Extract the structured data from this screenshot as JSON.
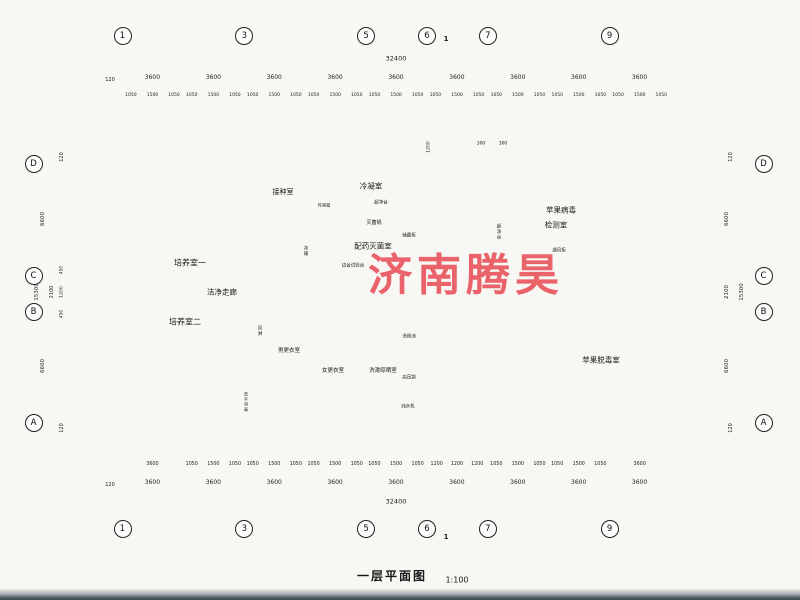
{
  "watermark": {
    "text": "济南腾昊",
    "color": "#e8434e"
  },
  "title": {
    "name": "一层平面图",
    "scale": "1:100"
  },
  "section_mark": {
    "top": "1",
    "bottom": "1"
  },
  "grid_bubbles": {
    "top": [
      "1",
      "3",
      "5",
      "6",
      "7",
      "9"
    ],
    "bottom": [
      "1",
      "3",
      "5",
      "6",
      "7",
      "9"
    ],
    "left": [
      "D",
      "C",
      "B",
      "A"
    ],
    "right": [
      "D",
      "C",
      "B",
      "A"
    ]
  },
  "dims": {
    "top": {
      "overall": "32400",
      "edge": "120",
      "bays": [
        "3600",
        "3600",
        "3600",
        "3600",
        "3600",
        "3600",
        "3600",
        "3600",
        "3600"
      ],
      "sub": [
        "1050",
        "1500",
        "1050",
        "1050",
        "1500",
        "1050",
        "1050",
        "1500",
        "1050",
        "1050",
        "1500",
        "1050",
        "1050",
        "1500",
        "1050",
        "1050",
        "1500",
        "1050",
        "1050",
        "1500",
        "1050",
        "1050",
        "1500",
        "1050",
        "1050",
        "1500",
        "1050"
      ]
    },
    "bottom": {
      "overall": "32400",
      "edge": "120",
      "bays": [
        "3600",
        "3600",
        "3600",
        "3600",
        "3600",
        "3600",
        "3600",
        "3600",
        "3600"
      ],
      "sub": [
        "3600",
        "1050",
        "1500",
        "1050",
        "1050",
        "1500",
        "1050",
        "1050",
        "1500",
        "1050",
        "1050",
        "1500",
        "1050",
        "1200",
        "1200",
        "1200",
        "1050",
        "1500",
        "1050",
        "1050",
        "1500",
        "1050",
        "3600"
      ]
    },
    "left": [
      "120",
      "6600",
      "450",
      "2100",
      "1200",
      "15300",
      "450",
      "6600",
      "120"
    ],
    "right": [
      "120",
      "6600",
      "2100",
      "15300",
      "6600",
      "120"
    ],
    "entrance": {
      "depth": "1200",
      "left": "300",
      "right": "300"
    }
  },
  "rooms": {
    "culture1": "培养室一",
    "inoculation": "接种室",
    "condensing": "冷凝室",
    "dispensing": "配药灭菌室",
    "virus_test_line1": "苹果病毒",
    "virus_test_line2": "检测室",
    "corridor": "洁净走廊",
    "culture2": "培养室二",
    "men_changing": "男更衣室",
    "women_changing": "女更衣室",
    "washing": "洗漱晾晒室",
    "detox": "苹果脱毒室"
  },
  "equipment": {
    "autoclave": "灭菌锅",
    "clean_bench_small": "超净台",
    "storage_cabinet": "储藏柜",
    "pass_window": "传递窗",
    "fridge": "冰箱",
    "side_bench": "边台试验台",
    "fume_hood": "通风柜",
    "clean_bench": "超净台",
    "air_shower": "风淋",
    "hand_wash": "洗手消毒",
    "wash_sink": "洗刷池",
    "pressure_pot": "高压锅",
    "water_purifier": "纯水机"
  }
}
